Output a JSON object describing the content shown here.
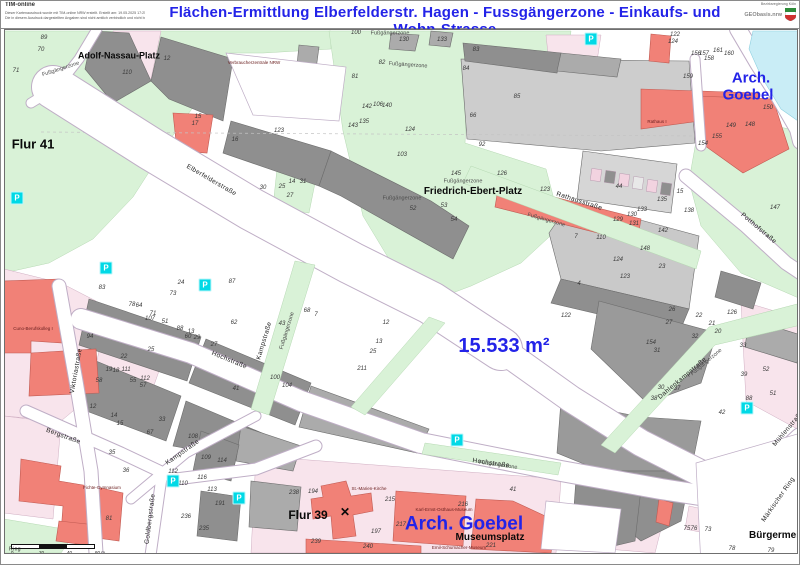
{
  "header": {
    "app_name": "TIM-online",
    "disclaimer_line1": "Dieser Kartenausdruck wurde mit TIM-online NRW erstellt. Erstellt am: 19.05.2025 17:25 Uhr",
    "disclaimer_line2": "Die in diesem Ausdruck dargestellten Angaben sind nicht amtlich verbindlich und nicht beglaubigt. Es gelten die Nutzungsbedingungen.",
    "title": "Flächen-Ermittlung Elberfelderstr. Hagen - Fussgängerzone - Einkaufs- und Wohn-Strasse",
    "logo_caption": "Bezirksregierung Köln",
    "logo_text": "GEObasis.nrw"
  },
  "colors": {
    "title_blue": "#2323e8",
    "annotation_blue": "#2323e8",
    "pedestrian_green": "#d9f2d7",
    "building_gray": "#8f8f8f",
    "building_red": "#f18177",
    "parcel_pink": "#f8e4ec",
    "water_cyan": "#c9edf6",
    "parking_cyan": "#00d9e6"
  },
  "map": {
    "annotations": [
      {
        "text": "15.533 m²",
        "x": 503,
        "y": 345,
        "size": 20
      },
      {
        "text": "Arch.",
        "x": 750,
        "y": 77,
        "size": 15
      },
      {
        "text": "Goebel",
        "x": 747,
        "y": 94,
        "size": 15
      },
      {
        "text": "Arch. Goebel",
        "x": 463,
        "y": 523,
        "size": 19
      }
    ],
    "place_labels": [
      {
        "text": "Adolf-Nassau-Platz",
        "x": 118,
        "y": 55,
        "size": 9
      },
      {
        "text": "Flur 41",
        "x": 32,
        "y": 143,
        "size": 13
      },
      {
        "text": "Friedrich-Ebert-Platz",
        "x": 472,
        "y": 191,
        "size": 10
      },
      {
        "text": "Flur 39",
        "x": 307,
        "y": 514,
        "size": 12
      },
      {
        "text": "Museumsplatz",
        "x": 489,
        "y": 537,
        "size": 10
      },
      {
        "text": "Bürgermeister",
        "x": 748,
        "y": 535,
        "size": 10,
        "clip": true
      }
    ],
    "street_labels": [
      {
        "text": "Elberfelderstraße",
        "x": 210,
        "y": 180,
        "rot": 30
      },
      {
        "text": "Hochstraße",
        "x": 228,
        "y": 360,
        "rot": 22
      },
      {
        "text": "Hochstraße",
        "x": 490,
        "y": 463,
        "rot": 8
      },
      {
        "text": "Kampstraße",
        "x": 264,
        "y": 340,
        "rot": -73
      },
      {
        "text": "Kampstraße",
        "x": 182,
        "y": 452,
        "rot": -35
      },
      {
        "text": "Bergstraße",
        "x": 62,
        "y": 436,
        "rot": 20
      },
      {
        "text": "Goldbergstraße",
        "x": 150,
        "y": 518,
        "rot": -83
      },
      {
        "text": "Viktoriastraße",
        "x": 76,
        "y": 370,
        "rot": -80
      },
      {
        "text": "Rathausstraße",
        "x": 578,
        "y": 201,
        "rot": 18
      },
      {
        "text": "Potthofstraße",
        "x": 757,
        "y": 228,
        "rot": 40
      },
      {
        "text": "Dahlenkampstraße",
        "x": 682,
        "y": 378,
        "rot": -40
      },
      {
        "text": "Märkischer Ring",
        "x": 778,
        "y": 499,
        "rot": -55
      },
      {
        "text": "Mühlenstraße",
        "x": 788,
        "y": 428,
        "rot": -50
      },
      {
        "text": "Ring",
        "x": 14,
        "y": 549,
        "rot": 0,
        "size": 5
      }
    ],
    "pedestrian_zone_labels": [
      {
        "text": "Fußgängerzone",
        "x": 389,
        "y": 33,
        "rot": 0
      },
      {
        "text": "Fußgängerzone",
        "x": 60,
        "y": 69,
        "rot": -18
      },
      {
        "text": "Fußgängerzone",
        "x": 407,
        "y": 65,
        "rot": 4
      },
      {
        "text": "Fußgängerzone",
        "x": 462,
        "y": 181,
        "rot": 0
      },
      {
        "text": "Fußgängerzone",
        "x": 401,
        "y": 198,
        "rot": 0
      },
      {
        "text": "Fußgängerzone",
        "x": 545,
        "y": 220,
        "rot": 16
      },
      {
        "text": "Fußgängerzone",
        "x": 287,
        "y": 330,
        "rot": -73
      },
      {
        "text": "Fußgängerzone",
        "x": 706,
        "y": 362,
        "rot": -40
      },
      {
        "text": "Fußgängerzone",
        "x": 497,
        "y": 465,
        "rot": 8
      }
    ],
    "building_labels": [
      {
        "text": "St.-Marien-Kirche",
        "x": 368,
        "y": 488
      },
      {
        "text": "Karl-Ernst-Osthaus-Museum",
        "x": 443,
        "y": 509
      },
      {
        "text": "Emil-Schumacher-Museum",
        "x": 458,
        "y": 547
      },
      {
        "text": "Fichte-Gymnasium",
        "x": 101,
        "y": 487
      },
      {
        "text": "Rathaus I",
        "x": 656,
        "y": 121
      },
      {
        "text": "Verbraucherzentrale NRW",
        "x": 253,
        "y": 62
      },
      {
        "text": "Cuno-Berufskolleg I",
        "x": 32,
        "y": 328
      }
    ],
    "church_cross": {
      "symbol": "✕",
      "x": 344,
      "y": 511
    },
    "parcel_numbers": [
      [
        89,
        43,
        37
      ],
      [
        70,
        40,
        49
      ],
      [
        71,
        15,
        70
      ],
      [
        110,
        126,
        72
      ],
      [
        12,
        166,
        58
      ],
      [
        145,
        455,
        173
      ],
      [
        92,
        481,
        144
      ],
      [
        126,
        501,
        173
      ],
      [
        123,
        544,
        189
      ],
      [
        44,
        618,
        186
      ],
      [
        53,
        443,
        205
      ],
      [
        52,
        412,
        208
      ],
      [
        54,
        453,
        219
      ],
      [
        103,
        401,
        154
      ],
      [
        129,
        617,
        219
      ],
      [
        131,
        633,
        223
      ],
      [
        122,
        674,
        34
      ],
      [
        124,
        672,
        41
      ],
      [
        161,
        717,
        50
      ],
      [
        156,
        695,
        53
      ],
      [
        157,
        703,
        53
      ],
      [
        158,
        708,
        58
      ],
      [
        160,
        728,
        53
      ],
      [
        159,
        687,
        76
      ],
      [
        150,
        767,
        107
      ],
      [
        149,
        730,
        125
      ],
      [
        148,
        749,
        124
      ],
      [
        155,
        716,
        136
      ],
      [
        154,
        702,
        143
      ],
      [
        238,
        293,
        492
      ],
      [
        194,
        312,
        491
      ],
      [
        215,
        389,
        499
      ],
      [
        217,
        400,
        524
      ],
      [
        197,
        375,
        531
      ],
      [
        239,
        315,
        541
      ],
      [
        240,
        367,
        546
      ],
      [
        216,
        462,
        504
      ],
      [
        221,
        490,
        545
      ],
      [
        41,
        512,
        489
      ],
      [
        78,
        731,
        548
      ],
      [
        79,
        770,
        550
      ],
      [
        73,
        707,
        529
      ],
      [
        75,
        686,
        528
      ],
      [
        76,
        693,
        528
      ],
      [
        83,
        101,
        287
      ],
      [
        78,
        131,
        304
      ],
      [
        64,
        138,
        305
      ],
      [
        71,
        152,
        313
      ],
      [
        107,
        149,
        318
      ],
      [
        51,
        164,
        321
      ],
      [
        24,
        180,
        282
      ],
      [
        73,
        172,
        293
      ],
      [
        87,
        231,
        281
      ],
      [
        88,
        179,
        328
      ],
      [
        13,
        190,
        331
      ],
      [
        60,
        187,
        336
      ],
      [
        29,
        196,
        337
      ],
      [
        94,
        89,
        336
      ],
      [
        25,
        150,
        349
      ],
      [
        22,
        123,
        356
      ],
      [
        19,
        108,
        369
      ],
      [
        18,
        115,
        370
      ],
      [
        111,
        125,
        369
      ],
      [
        58,
        98,
        380
      ],
      [
        55,
        132,
        380
      ],
      [
        112,
        144,
        378
      ],
      [
        57,
        142,
        385
      ],
      [
        62,
        233,
        322
      ],
      [
        100,
        274,
        377
      ],
      [
        104,
        286,
        385
      ],
      [
        41,
        235,
        388
      ],
      [
        27,
        213,
        344
      ],
      [
        15,
        197,
        116
      ],
      [
        17,
        194,
        123
      ],
      [
        123,
        278,
        130
      ],
      [
        16,
        234,
        139
      ],
      [
        14,
        291,
        181
      ],
      [
        31,
        302,
        181
      ],
      [
        25,
        281,
        186
      ],
      [
        27,
        289,
        195
      ],
      [
        30,
        262,
        187
      ],
      [
        43,
        281,
        323
      ],
      [
        68,
        306,
        310
      ],
      [
        7,
        315,
        314
      ],
      [
        13,
        378,
        341
      ],
      [
        25,
        372,
        351
      ],
      [
        211,
        361,
        368
      ],
      [
        12,
        385,
        322
      ],
      [
        100,
        355,
        32
      ],
      [
        130,
        403,
        39
      ],
      [
        133,
        441,
        39
      ],
      [
        82,
        381,
        62
      ],
      [
        83,
        475,
        49
      ],
      [
        84,
        465,
        68
      ],
      [
        85,
        516,
        96
      ],
      [
        81,
        354,
        76
      ],
      [
        142,
        366,
        106
      ],
      [
        106,
        377,
        104
      ],
      [
        140,
        386,
        105
      ],
      [
        135,
        363,
        121
      ],
      [
        143,
        352,
        125
      ],
      [
        124,
        409,
        129
      ],
      [
        66,
        472,
        115
      ],
      [
        12,
        92,
        406
      ],
      [
        14,
        113,
        415
      ],
      [
        15,
        119,
        423
      ],
      [
        33,
        161,
        419
      ],
      [
        67,
        149,
        432
      ],
      [
        35,
        111,
        452
      ],
      [
        36,
        125,
        470
      ],
      [
        81,
        108,
        518
      ],
      [
        108,
        192,
        436
      ],
      [
        109,
        205,
        457
      ],
      [
        114,
        221,
        460
      ],
      [
        116,
        201,
        477
      ],
      [
        110,
        182,
        483
      ],
      [
        112,
        172,
        471
      ],
      [
        113,
        211,
        489
      ],
      [
        191,
        219,
        503
      ],
      [
        236,
        185,
        516
      ],
      [
        235,
        203,
        528
      ],
      [
        26,
        671,
        309
      ],
      [
        27,
        668,
        322
      ],
      [
        22,
        698,
        315
      ],
      [
        21,
        711,
        323
      ],
      [
        20,
        717,
        331
      ],
      [
        126,
        731,
        312
      ],
      [
        32,
        694,
        336
      ],
      [
        33,
        742,
        345
      ],
      [
        31,
        656,
        350
      ],
      [
        154,
        650,
        342
      ],
      [
        30,
        660,
        387
      ],
      [
        37,
        676,
        388
      ],
      [
        38,
        653,
        398
      ],
      [
        39,
        743,
        374
      ],
      [
        52,
        765,
        369
      ],
      [
        51,
        772,
        393
      ],
      [
        88,
        748,
        398
      ],
      [
        42,
        721,
        412
      ],
      [
        147,
        774,
        207
      ],
      [
        110,
        600,
        237
      ],
      [
        124,
        617,
        259
      ],
      [
        123,
        624,
        276
      ],
      [
        4,
        578,
        283
      ],
      [
        7,
        575,
        236
      ],
      [
        148,
        644,
        248
      ],
      [
        142,
        662,
        230
      ],
      [
        23,
        661,
        266
      ],
      [
        135,
        661,
        199
      ],
      [
        133,
        641,
        209
      ],
      [
        130,
        631,
        214
      ],
      [
        138,
        688,
        210
      ],
      [
        15,
        679,
        191
      ],
      [
        122,
        565,
        315
      ]
    ],
    "parking_icons": [
      {
        "x": 16,
        "y": 197
      },
      {
        "x": 105,
        "y": 267
      },
      {
        "x": 204,
        "y": 284
      },
      {
        "x": 590,
        "y": 38
      },
      {
        "x": 746,
        "y": 407
      },
      {
        "x": 456,
        "y": 439
      },
      {
        "x": 172,
        "y": 480
      },
      {
        "x": 238,
        "y": 497
      }
    ],
    "scale_bar": {
      "ticks": [
        "0",
        "20",
        "40",
        "60 m"
      ]
    }
  }
}
